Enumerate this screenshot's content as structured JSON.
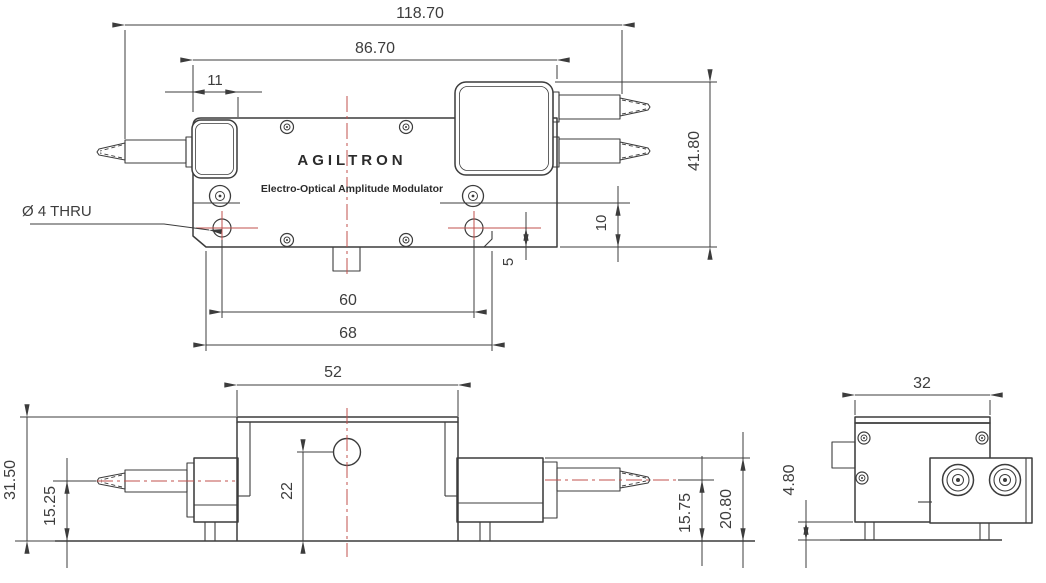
{
  "drawing": {
    "brand": "AGILTRON",
    "subtitle": "Electro-Optical Amplitude Modulator",
    "hole_callout": "Ø 4 THRU",
    "colors": {
      "line": "#3c3c3c",
      "centerline": "#c0504d",
      "text": "#3d3d3d"
    },
    "views": {
      "top": {
        "dims": {
          "overall_length": "118.70",
          "body_length": "86.70",
          "collimator_width": "11",
          "overall_width": "41.80",
          "flange_height": "10",
          "hole_edge_offset": "5",
          "hole_spacing": "60",
          "flange_length": "68"
        }
      },
      "front": {
        "dims": {
          "lid_width": "52",
          "overall_height": "31.50",
          "fiber_axis_left": "15.25",
          "hole_center_height": "22",
          "fiber_axis_right": "15.75",
          "block_height": "20.80"
        }
      },
      "side": {
        "dims": {
          "depth": "32",
          "base_height": "4.80"
        }
      }
    }
  }
}
